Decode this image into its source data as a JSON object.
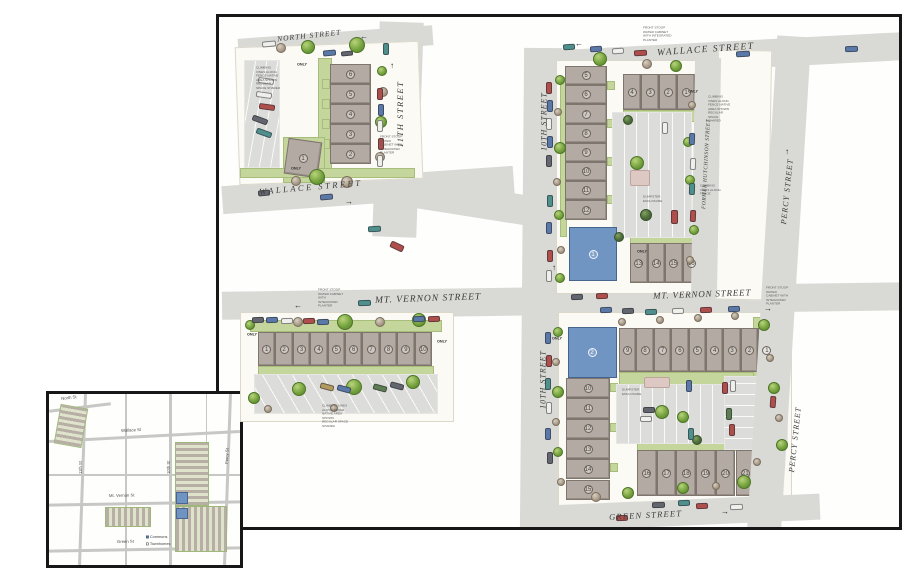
{
  "plan": {
    "streets": {
      "north": "NORTH STREET",
      "wallace_left": "WALLACE STREET",
      "wallace_right": "WALLACE STREET",
      "eleventh": "11TH STREET",
      "tenth_upper": "10TH STREET",
      "tenth_lower": "10TH STREET",
      "hutchinson": "FORMER HUTCHINSON STREET",
      "percy_upper": "PERCY STREET",
      "percy_lower": "PERCY STREET",
      "mt_vernon_left": "MT. VERNON STREET",
      "mt_vernon_right": "MT. VERNON STREET",
      "green": "GREEN STREET"
    },
    "annotations": {
      "front_stoop": "FRONT STOOP WATER CABINET WITH INTEGRATED PLANTER",
      "vines_long": "CLIMBING VINES ALONG FENCE NATIVE AREA SHOWN REGULAR SPACE SHARED",
      "vines_short": "CLIMBING VINES ALONG FENCE",
      "dumpster": "DUMPSTER ENCLOSURE"
    },
    "only_label": "ONLY",
    "glyphs": {
      "arrow_up": "↑",
      "arrow_down": "↓",
      "arrow_left": "←",
      "arrow_right": "→"
    },
    "blocks": {
      "a": {
        "units": [
          "6",
          "5",
          "4",
          "3",
          "2"
        ],
        "unit1": "1"
      },
      "b": {
        "left_units": [
          "5",
          "6",
          "7",
          "8",
          "9",
          "10",
          "11",
          "12"
        ],
        "top_units": [
          "4",
          "3",
          "2",
          "1"
        ],
        "bottom_units": [
          "13",
          "14",
          "15",
          "16"
        ],
        "commons": "1"
      },
      "c": {
        "units": [
          "1",
          "2",
          "3",
          "4",
          "5",
          "6",
          "7",
          "8",
          "9",
          "10"
        ]
      },
      "d": {
        "top_units": [
          "9",
          "8",
          "7",
          "6",
          "5",
          "4",
          "3",
          "2",
          "1"
        ],
        "left_units": [
          "10",
          "11",
          "12",
          "13",
          "14",
          "15"
        ],
        "bottom_units": [
          "16",
          "17",
          "18",
          "19",
          "20",
          "21"
        ],
        "commons": "2"
      }
    }
  },
  "inset": {
    "streets": {
      "north": "North St",
      "wallace": "Wallace St",
      "eleventh": "11th St",
      "tenth": "10th St",
      "percy": "Percy St",
      "mt_vernon": "Mt. Vernon St",
      "green": "Green St"
    },
    "legend": [
      {
        "label": "Commons"
      },
      {
        "label": "Townhomes"
      }
    ]
  },
  "colors": {
    "street": "#d9d9d6",
    "building": "#b3aaa3",
    "landscape": "#c5d69c",
    "commons_blue": "#7095c3"
  }
}
